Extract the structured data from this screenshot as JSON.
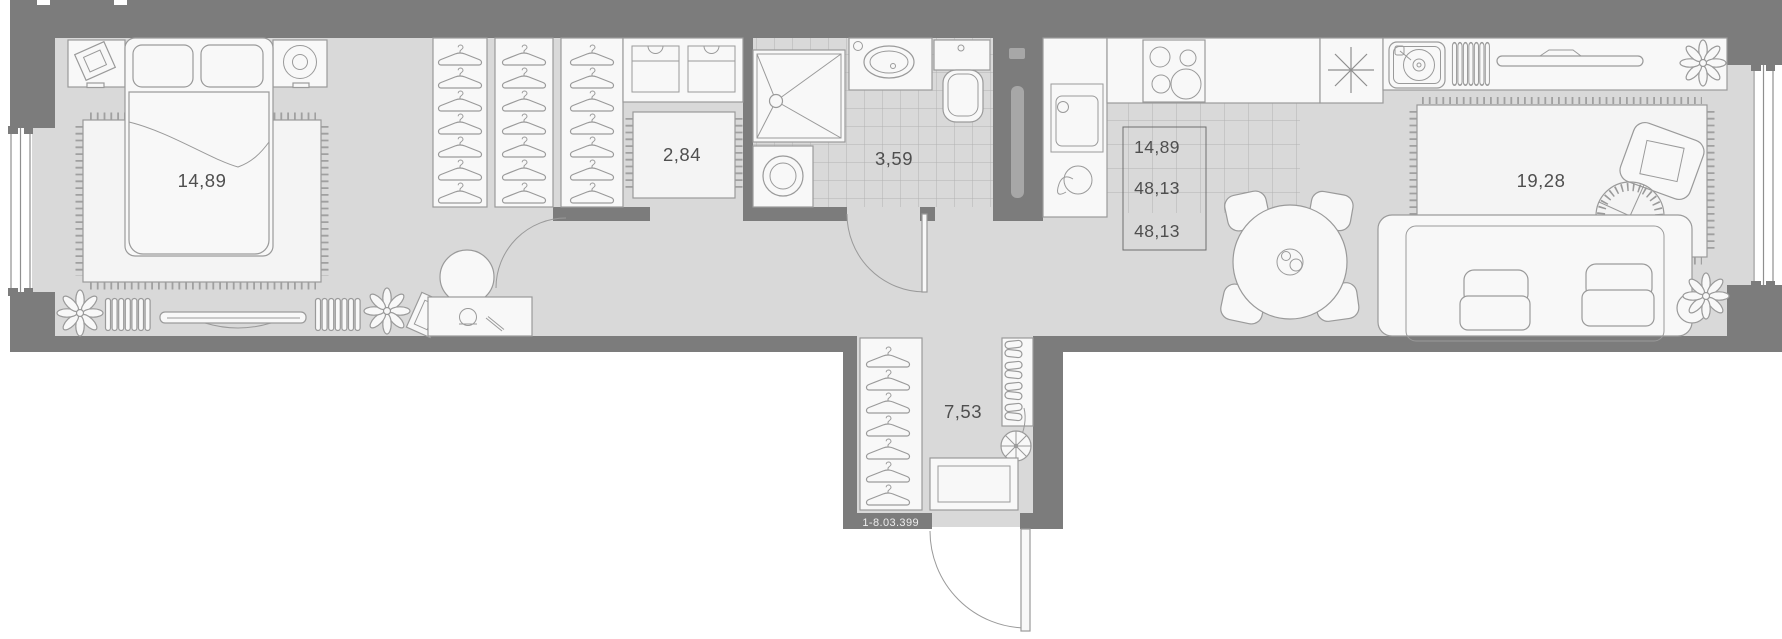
{
  "floorplan": {
    "unit_code": "1-8.03.399",
    "rooms": {
      "bedroom": {
        "area": "14,89"
      },
      "dressing_room": {
        "area": "2,84"
      },
      "bathroom": {
        "area": "3,59"
      },
      "hall": {
        "area": "7,53"
      },
      "living_room": {
        "area": "19,28"
      }
    },
    "area_summary": [
      "14,89",
      "48,13",
      "48,13"
    ],
    "colors": {
      "wall": "#7c7c7c",
      "floor": "#d9d9d9",
      "furniture_fill": "#f8f8f8",
      "outline": "#9a9a9a",
      "label_text": "#4f4f4f",
      "badge_text": "#ededed"
    }
  }
}
